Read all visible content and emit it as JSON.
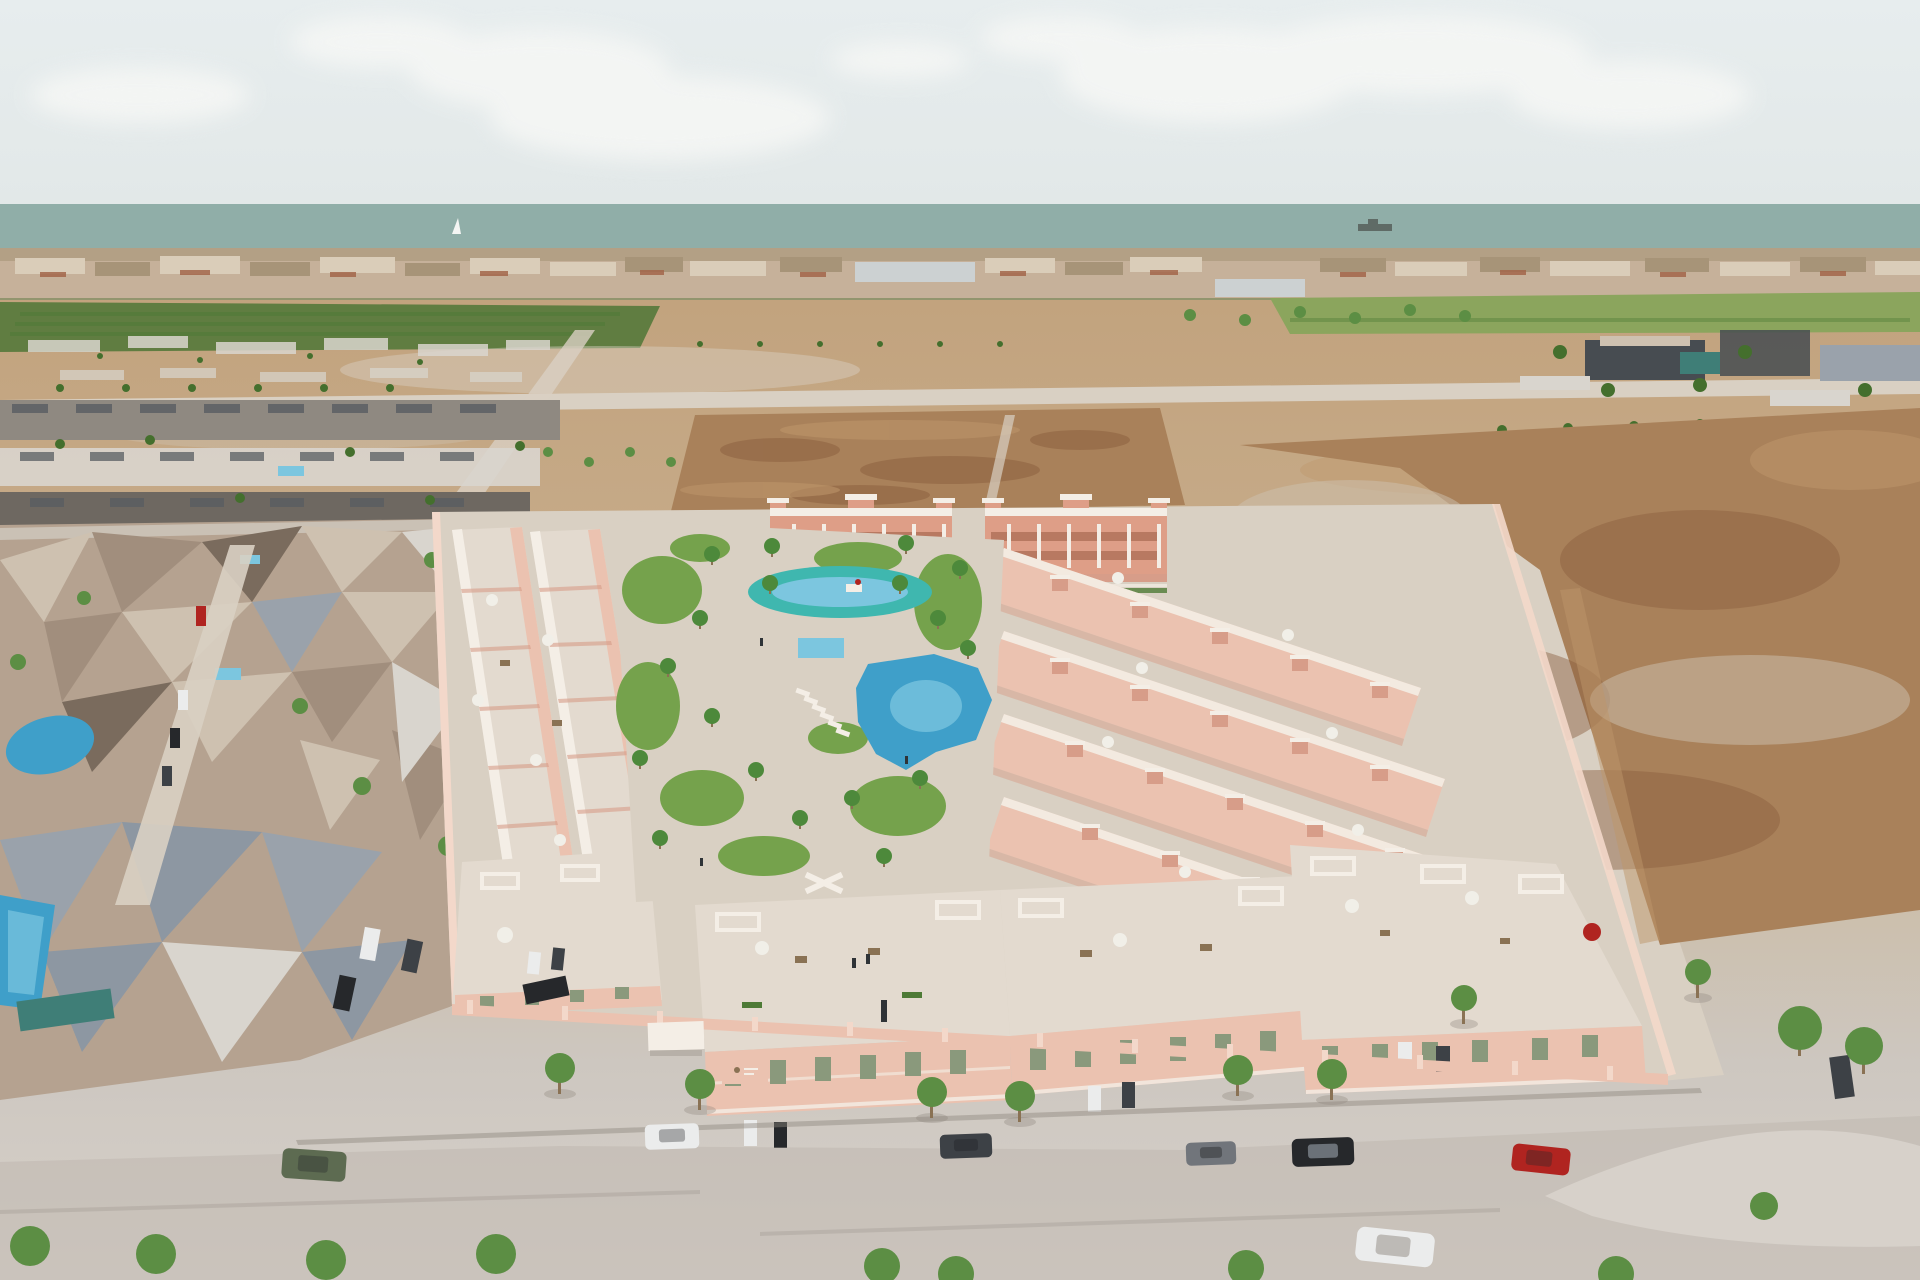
{
  "meta": {
    "title": "Aerial 3D architectural rendering of a new-build residential development by the sea",
    "type": "3d-architectural-aerial-render"
  },
  "scene": {
    "description": "Aerial 3D visualization of a gated new-build complex of pink two-storey townhouses with roof terraces arranged around a central landscaped park containing a large freeform swimming pool, a turquoise children's lagoon pool, a toddler pool, lawns and palm trees. Three-storey salmon apartment blocks with crenellated roof towers close the rear of the plot. An existing low-poly photogrammetry neighbourhood sits on the left, vacant brown building plots on the right, and streets with young trees and parked cars surround the site. Farmland, a coastal town strip and the sea with a cargo ship and a sailboat lie on the hazy horizon.",
    "elements": [
      "hazy sky with soft clouds",
      "sea horizon with cargo ship and sailboat",
      "coastal town strip with terracotta roofs",
      "orchards and green fields",
      "sandy vacant plots with rows of young trees",
      "existing low-poly neighbourhood mesh with small pools and parked cars",
      "new development: pink townhouse rows with white roof terraces and parasols",
      "two three-storey apartment blocks with crenellated towers",
      "central park with freeform pool, lagoon pool, toddler pool, lawns, palms, sun loungers",
      "front townhouse blocks with white roof pergolas and driveway cars",
      "perimeter wall with piers, entrance kiosk and project sign",
      "foreground streets with parked cars and street trees",
      "brown vacant plot and industrial sheds top right"
    ],
    "details": {
      "pool_count": 3,
      "apartment_blocks": 2,
      "right_townhouse_rows": 4,
      "front_blocks": 3
    },
    "colors": {
      "sky_top": "#e7edee",
      "sky_bottom": "#e2e8e8",
      "cloud": "#f6f7f5",
      "sea": "#90aea8",
      "ship": "#5f6b66",
      "sail": "#f4f5f3",
      "city_base": "#c6b19a",
      "city_light": "#dacdb9",
      "city_mid": "#a79478",
      "city_roof": "#a2664a",
      "city_white": "#ccd1d2",
      "city_treeline": "#5d7a41",
      "orchard": "#607d41",
      "field": "#8ba55d",
      "hedge": "#4e7a36",
      "sand_top": "#c2a37e",
      "sand_mid": "#c8ae8d",
      "sand_low": "#ccbda7",
      "concrete": "#cdc7c0",
      "concrete_light": "#d7d1ca",
      "dirt": "#a9815a",
      "dirt_dark": "#8a5e3d",
      "dirt_light": "#bd9569",
      "road_light": "#d9d0c3",
      "road_grey": "#bdb6ad",
      "shadow": "#8f887f",
      "mesh_tan": "#b5a290",
      "mesh_light": "#cec1b0",
      "mesh_mid": "#a18e7d",
      "mesh_dark": "#7a6b5d",
      "mesh_grey": "#9aa2ab",
      "mesh_white": "#d9d5ce",
      "mesh_blue": "#8d97a2",
      "house_grey": "#8f8981",
      "house_grey_dark": "#6e6861",
      "roof_grey": "#595d62",
      "pool_blue": "#3f9fc9",
      "pool_light": "#7cc6df",
      "pool_teal": "#3fb7af",
      "lawn": "#75a24c",
      "tree": "#5c8e44",
      "tree_dark": "#446f2d",
      "trunk": "#8a7254",
      "palm": "#4d893b",
      "wall_pink": "#ebc2b0",
      "wall_pink_light": "#f3d8ca",
      "wall_pink_dark": "#d79d89",
      "wall_salmon": "#de9e87",
      "window_band": "#b4755d",
      "trim_white": "#f4eee6",
      "roof_terrace": "#e3dacf",
      "window_green": "#8a997c",
      "car_white": "#ebecec",
      "car_black": "#26282b",
      "car_dark": "#3d4146",
      "car_grey": "#71757b",
      "car_red": "#b02420",
      "car_green": "#5d6b51",
      "umbrella": "#f1efe8",
      "person": "#2f3337",
      "industrial_dark": "#474c51",
      "industrial_teal": "#3f7e77"
    }
  }
}
